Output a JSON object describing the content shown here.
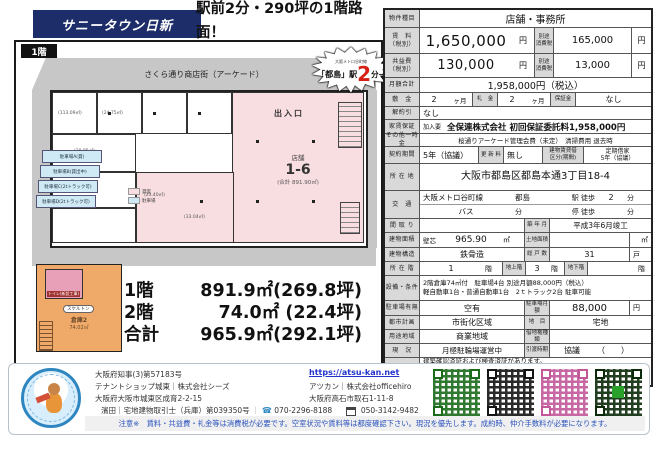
{
  "colors": {
    "banner_navy": "#1c2d69",
    "plan_pink": "#f8dde1",
    "plan_orange": "#efa968",
    "parking_blue": "#cfe9f5",
    "label_gray": "#d9d9d9",
    "note_blue": "#2a52be",
    "accent_red": "#d42015",
    "link_blue": "#2233cc"
  },
  "header": {
    "banner": "サニータウン日新",
    "headline_line1": "駅前2分・290坪の1階路面！",
    "headline_line2": "月195万円で独占!"
  },
  "floorplan": {
    "floor_badge": "1階",
    "street_label": "さくら通り商店街（アーケード）",
    "station_badge": {
      "line": "大阪メトロ谷町線",
      "station": "「都島」駅",
      "minutes": "2",
      "suffix": "分→"
    },
    "entrance_label": "出入口",
    "shop": {
      "type": "店舗",
      "number": "1-6",
      "total_area": "(合計 891.90㎡)"
    },
    "room_areas": [
      "(113.09㎡)",
      "(24.75㎡)",
      "(28.85㎡)",
      "(30.79㎡)",
      "(23.40㎡)",
      "(33.04㎡)"
    ],
    "parking_spaces": [
      "駐車場A(貸)",
      "駐車場B(貸出中)",
      "駐車場C(2tトラック可)",
      "駐車場D(2tトラック可)"
    ],
    "legend": [
      {
        "label": "貸室",
        "color": "#f8dde1"
      },
      {
        "label": "駐車場",
        "color": "#cfe9f5"
      }
    ],
    "second_floor": {
      "toilet": "トイレ(新設工事)",
      "skeleton": "スケルトン",
      "warehouse": "倉庫2",
      "warehouse_area": "74.02㎡"
    },
    "summary": [
      {
        "label": "1階",
        "value": "891.9㎡(269.8坪)"
      },
      {
        "label": "2階",
        "value": "74.0㎡ (22.4坪)"
      },
      {
        "label": "合計",
        "value": "965.9㎡(292.1坪)"
      }
    ]
  },
  "table": {
    "property_type": {
      "label": "物件種目",
      "value": "店舗・事務所"
    },
    "rent": {
      "label": "賃　料\n（税別）",
      "amount": "1,650,000",
      "unit": "円",
      "tax_label": "別途\n消費税",
      "tax_amount": "165,000",
      "tax_unit": "円"
    },
    "common_fee": {
      "label": "共益費\n（税別）",
      "amount": "130,000",
      "unit": "円",
      "tax_label": "別途\n消費税",
      "tax_amount": "13,000",
      "tax_unit": "円"
    },
    "monthly_total": {
      "label": "月額合計",
      "value": "1,958,000円（税込）"
    },
    "deposit": {
      "label": "敷　金",
      "value": "2",
      "unit": "ヶ月",
      "key_label": "礼　金",
      "key_value": "2",
      "key_unit": "ヶ月",
      "guarantee_label": "保証金",
      "guarantee_value": "なし"
    },
    "cancellation": {
      "label": "解約引",
      "value": "なし"
    },
    "rent_guarantee": {
      "label": "家賃保証",
      "sub_label": "加入要",
      "value": "全保連株式会社 初回保証委託料1,958,000円"
    },
    "other_fees": {
      "label": "その他一時金",
      "value": "桜通りアーケード管理会費（未定）　清掃費用 退去時"
    },
    "contract": {
      "label": "契約期間",
      "value": "5年（協議）",
      "renewal_label": "更 新 料",
      "renewal_value": "無し",
      "lease_label": "建物賃貸借\n区分(期間)",
      "lease_value": "定期借家\n5年（協議）"
    },
    "address": {
      "label": "所 在 地",
      "value": "大阪市都島区都島本通3丁目18-4"
    },
    "transit": {
      "label": "交　通",
      "line": "大阪メトロ谷町線",
      "station": "都島",
      "walk_prefix": "駅 徒歩",
      "walk_min": "2",
      "walk_unit": "分",
      "bus_label": "バス",
      "bus_min": "分",
      "stop_prefix": "停 徒歩",
      "stop_unit": "分"
    },
    "layout_row": {
      "label": "間 取 り",
      "value": "",
      "built_label": "築 年 月",
      "built_value": "平成3年6月竣工"
    },
    "building_area": {
      "label": "建物面積",
      "method": "壁芯",
      "value": "965.90",
      "unit": "㎡",
      "land_label": "土地面積",
      "land_value": "",
      "land_unit": "㎡"
    },
    "structure": {
      "label": "建物構造",
      "value": "鉄骨造",
      "units_label": "総 戸 数",
      "units_value": "31",
      "units_unit": "戸"
    },
    "floor": {
      "label": "所 在 階",
      "value": "1",
      "unit": "階",
      "above_label": "地上階",
      "above_value": "3",
      "above_unit": "階",
      "below_label": "地下階",
      "below_value": "",
      "below_unit": "階"
    },
    "equipment": {
      "label": "設備・条件",
      "line1": "2階倉庫74㎡付　駐車場4台 別途月額88,000円（税込）",
      "line2": "軽自動車1台・普通自動車1台　2ｔトラック2台 駐車可能"
    },
    "parking": {
      "label": "駐車場有無",
      "value": "空有",
      "fee_label": "駐車場月額",
      "fee_value": "88,000",
      "fee_unit": "円"
    },
    "city_planning": {
      "label": "都市計画",
      "value": "市街化区域",
      "cat_label": "地　目",
      "cat_value": "宅地"
    },
    "zoning": {
      "label": "用途地域",
      "value": "商業地域",
      "leasehold_label": "借地権種類",
      "leasehold_value": ""
    },
    "status": {
      "label": "現　況",
      "value": "月極駐輪場運営中",
      "handover_label": "引渡時期",
      "handover_value": "協議",
      "handover_paren": "（　　）"
    },
    "remarks": {
      "label": "備　考",
      "line1": "建築確認済証および検査済証があります。",
      "line2": "火災保険は借主にて付保",
      "line3": "引き渡し時期については協議。"
    }
  },
  "footer": {
    "license": "大阪府知事(3)第57183号",
    "shop": "テナントショップ城東｜株式会社シーズ",
    "shop_address": "大阪府大阪市城東区成育2-2-15",
    "agent": "濱田｜宅地建物取引士（兵庫）第039350号",
    "url": "https://atsu-kan.net",
    "brand": "アツカン｜株式会社officehiro",
    "brand_address": "大阪府高石市取石1-11-8",
    "phone": "070-2296-8188",
    "fax": "050-3142-9482",
    "note": "注意※　賃料・共益費・礼金等は消費税が必要です。空室状況や賃料等は都度確認下さい。現況を優先します。成約時、仲介手数料が必要になります。"
  }
}
